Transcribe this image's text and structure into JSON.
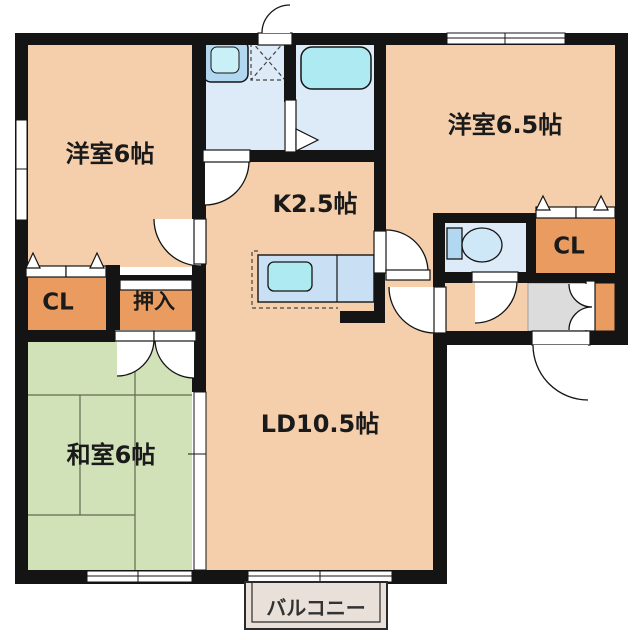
{
  "plan": {
    "type": "apartment-floor-plan",
    "rooms": [
      {
        "id": "bedroom1",
        "label": "洋室6帖"
      },
      {
        "id": "bedroom2",
        "label": "洋室6.5帖"
      },
      {
        "id": "kitchen",
        "label": "K2.5帖"
      },
      {
        "id": "living_dining",
        "label": "LD10.5帖"
      },
      {
        "id": "japanese_room",
        "label": "和室6帖"
      },
      {
        "id": "closet_left",
        "label": "CL"
      },
      {
        "id": "oshiire",
        "label": "押入"
      },
      {
        "id": "closet_right",
        "label": "CL"
      },
      {
        "id": "balcony",
        "label": "バルコニー"
      }
    ],
    "fixtures": [
      "washbasin",
      "washing-machine-pan",
      "bathtub",
      "toilet",
      "kitchen-counter-sink",
      "entrance-tile",
      "shoe-cabinet"
    ],
    "colors": {
      "wall": "#141414",
      "peach": "#f5cfab",
      "orange": "#ea9c60",
      "green": "#d2e2b8",
      "tatline": "#5f6b4f",
      "wet": "#dcebf7",
      "fixture": "#b2d7f1",
      "cyan": "#aeeaf2",
      "sinkin": "#c9f0f6",
      "counter": "#c9e0f4",
      "bowl": "#cfe8f8",
      "gray": "#dcdcdc",
      "balcony": "#e9e1d9"
    }
  }
}
